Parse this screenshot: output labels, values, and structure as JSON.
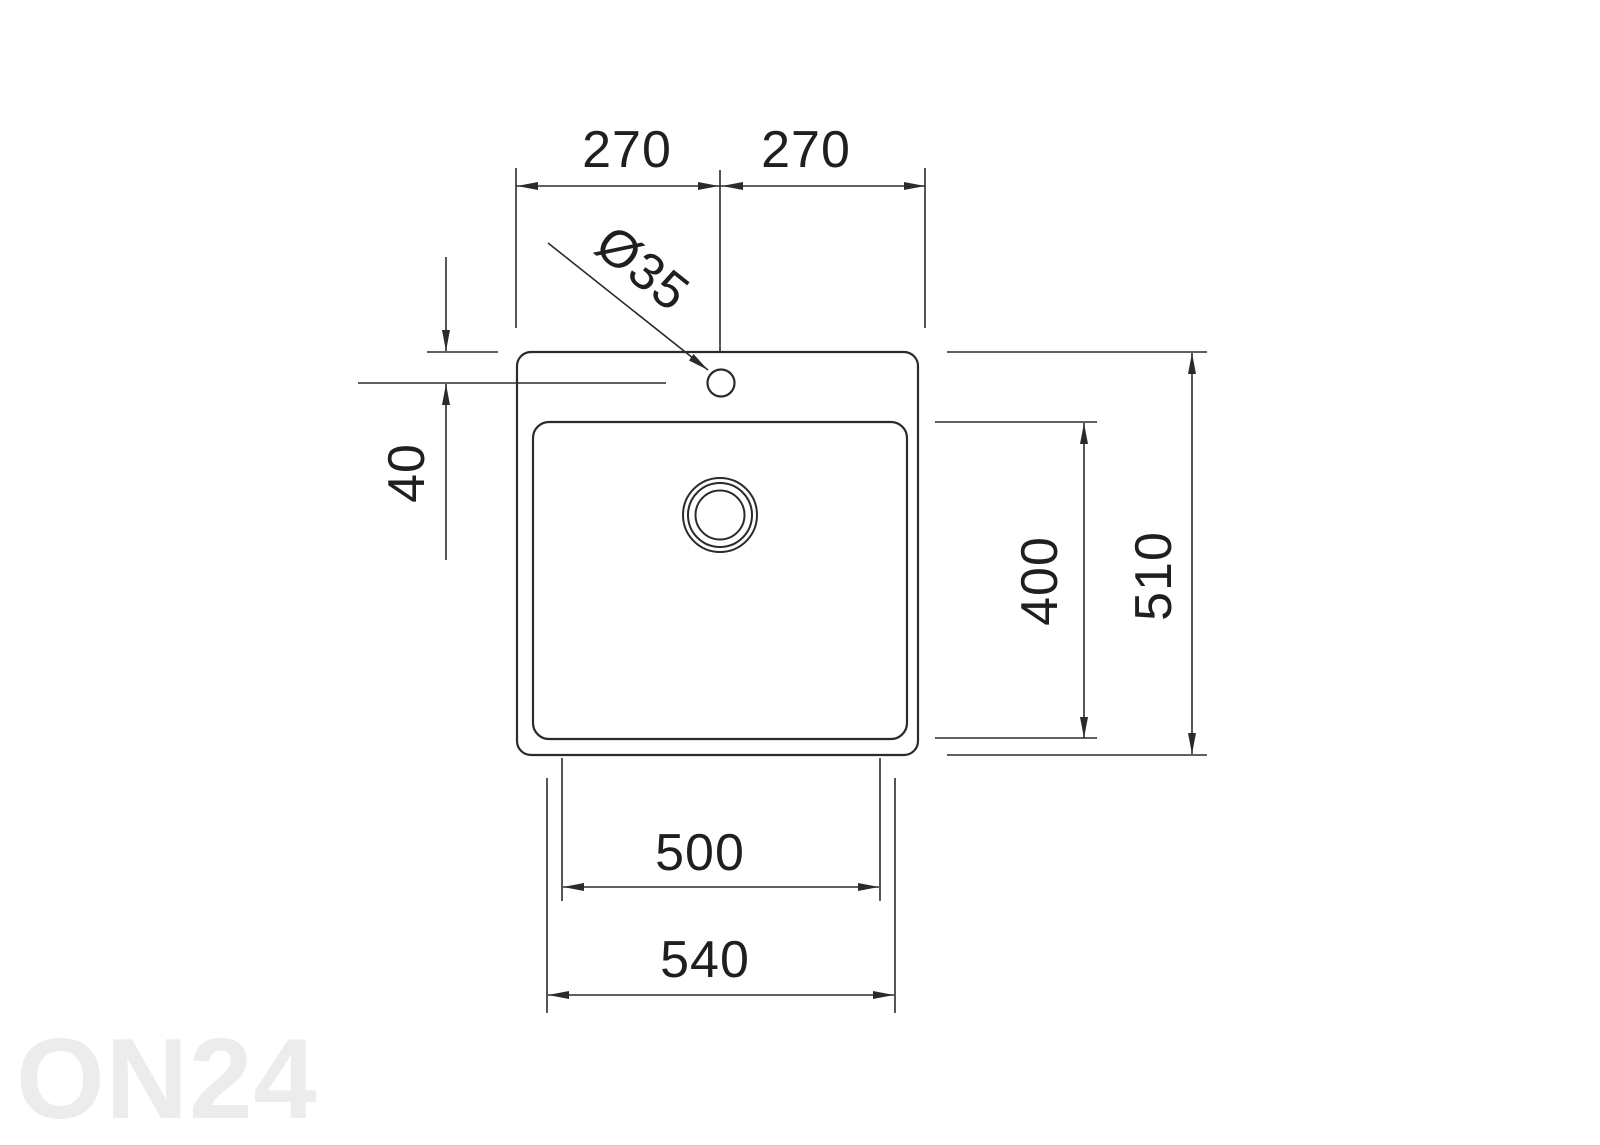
{
  "drawing": {
    "type": "technical-dimension-drawing",
    "subject": "sink-plan-view"
  },
  "dimensions": {
    "top_left_270": "270",
    "top_right_270": "270",
    "hole_diameter": "Ø35",
    "hole_offset_40": "40",
    "bowl_depth_400": "400",
    "outer_depth_510": "510",
    "bowl_width_500": "500",
    "outer_width_540": "540"
  },
  "watermark": {
    "text": "ON24",
    "color": "#ececec"
  },
  "colors": {
    "line": "#2b2b2b",
    "label_text": "#1f1f1f",
    "background": "#ffffff"
  }
}
